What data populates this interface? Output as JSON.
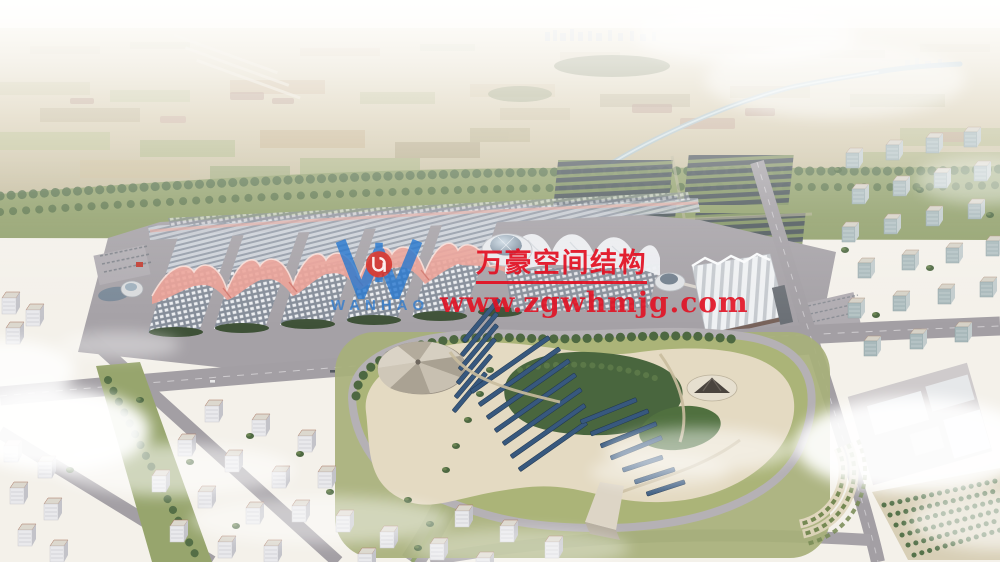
{
  "watermark": {
    "logo_monogram": "W",
    "logo_name": "WANHAO",
    "company_name_cn": "万豪空间结构",
    "website": "www.zgwhmjg.com",
    "brand_blue": "#2a79cf",
    "brand_red": "#e21022"
  }
}
